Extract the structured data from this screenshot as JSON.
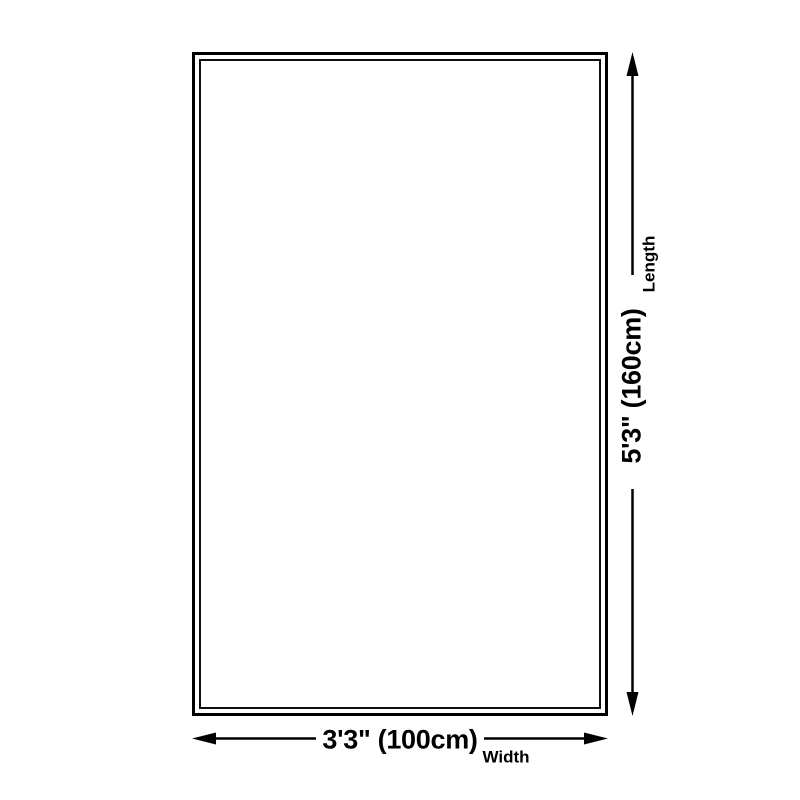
{
  "page": {
    "background_color": "#ffffff"
  },
  "diagram": {
    "type": "product-dimension-diagram",
    "rug_outline": {
      "outer_border_color": "#000000",
      "inner_border_color": "#0f0f0f"
    },
    "line_color": "#000000",
    "length": {
      "value": "5'3\" (160cm)",
      "label": "Length"
    },
    "width": {
      "value": "3'3\" (100cm)",
      "label": "Width"
    }
  }
}
